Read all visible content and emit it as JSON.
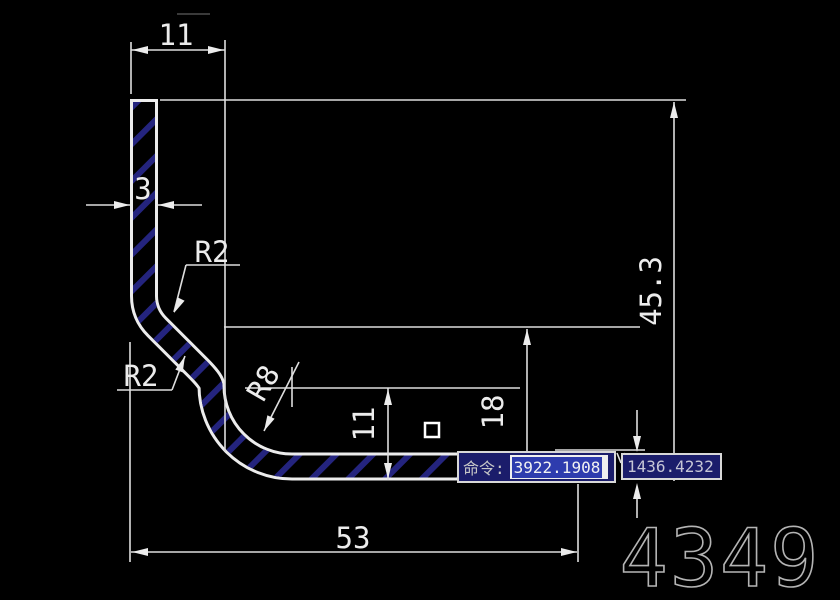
{
  "canvas": {
    "background": "#000000",
    "line_color": "#ececec",
    "hatch_color": "#24247e",
    "selection_color": "#2e3cae",
    "tooltip_color": "#1b1d6b"
  },
  "drawing": {
    "dim_top_width": "11",
    "dim_thickness": "3",
    "dim_radius_upper": "R2",
    "dim_radius_lower": "R2",
    "dim_radius_corner": "R8",
    "dim_leg_height": "11",
    "dim_mid_height": "18",
    "dim_total_height": "45.3",
    "dim_total_width": "53"
  },
  "command_bar": {
    "label": "命令:",
    "selected_value": "3922.1908",
    "second_value": "1436.4232"
  },
  "watermark": {
    "text": "4349"
  }
}
